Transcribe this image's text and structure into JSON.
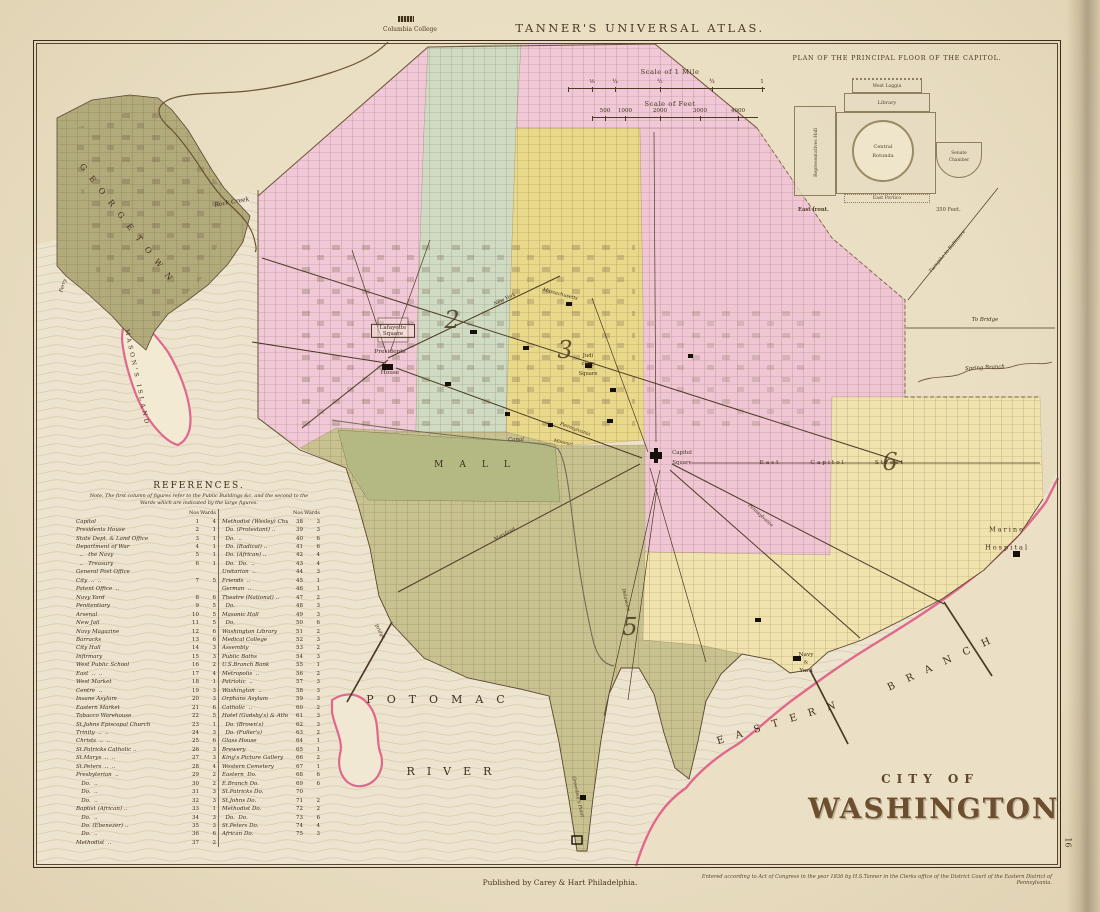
{
  "header": {
    "atlas_title": "TANNER'S UNIVERSAL ATLAS.",
    "columbia_college": "Columbia College"
  },
  "inset": {
    "title": "PLAN OF THE PRINCIPAL FLOOR OF THE CAPITOL.",
    "labels": {
      "west_loggia": "West Loggia",
      "library": "Library",
      "rep_hall": "Representatives Hall",
      "rotunda_1": "Central",
      "rotunda_2": "Rotunda",
      "senate_1": "Senate",
      "senate_2": "Chamber",
      "east_portico": "East Portico",
      "east_front": "East front.",
      "feet": "350 Feet."
    }
  },
  "scales": {
    "mile_title": "Scale of 1 Mile",
    "mile_ticks": [
      "⅛",
      "¼",
      "½",
      "¾",
      "1"
    ],
    "feet_title": "Scale of Feet",
    "feet_ticks": [
      "500",
      "1000",
      "2000",
      "3000",
      "4000"
    ]
  },
  "references": {
    "title": "REFERENCES.",
    "note_1": "Note. The first column of figures refer to the Public Buildings &c, and the second to the",
    "note_2": "Wards which are indicated by the large figures.",
    "col_no": "Nos",
    "col_wards": "Wards",
    "left": [
      {
        "n": "Capitol",
        "no": "1",
        "w": "4"
      },
      {
        "n": "Presidents House",
        "no": "2",
        "w": "1"
      },
      {
        "n": "State Dept. & Land Office",
        "no": "3",
        "w": "1"
      },
      {
        "n": "Department of War",
        "no": "4",
        "w": "1"
      },
      {
        "n": "  ..   the Navy",
        "no": "5",
        "w": "1"
      },
      {
        "n": "  ..   Treasury",
        "no": "6",
        "w": "1"
      },
      {
        "n": "General Post Office",
        "no": "",
        "w": ""
      },
      {
        "n": "City  ..  ..",
        "no": "7",
        "w": "5"
      },
      {
        "n": "Patent Office  ..",
        "no": "",
        "w": ""
      },
      {
        "n": "Navy Yard",
        "no": "8",
        "w": "6"
      },
      {
        "n": "Penitentiary",
        "no": "9",
        "w": "5"
      },
      {
        "n": "Arsenal",
        "no": "10",
        "w": "5"
      },
      {
        "n": "New Jail",
        "no": "11",
        "w": "5"
      },
      {
        "n": "Navy Magazine",
        "no": "12",
        "w": "6"
      },
      {
        "n": "Barracks",
        "no": "13",
        "w": "6"
      },
      {
        "n": "City Hall",
        "no": "14",
        "w": "3"
      },
      {
        "n": "Infirmary",
        "no": "15",
        "w": "3"
      },
      {
        "n": "West Public School",
        "no": "16",
        "w": "2"
      },
      {
        "n": "East  ..  ..",
        "no": "17",
        "w": "4"
      },
      {
        "n": "West Market",
        "no": "18",
        "w": "1"
      },
      {
        "n": "Centre  ..",
        "no": "19",
        "w": "3"
      },
      {
        "n": "Insane Asylum",
        "no": "20",
        "w": "3"
      },
      {
        "n": "Eastern Market",
        "no": "21",
        "w": "6"
      },
      {
        "n": "Tobacco Warehouse",
        "no": "22",
        "w": "5"
      },
      {
        "n": "St.Johns Episcopal Church",
        "no": "23",
        "w": "1"
      },
      {
        "n": "Trinity  ..  ..",
        "no": "24",
        "w": "3"
      },
      {
        "n": "Christs  ..  ..",
        "no": "25",
        "w": "6"
      },
      {
        "n": "St.Patricks Catholic ..",
        "no": "26",
        "w": "3"
      },
      {
        "n": "St.Marys  ..  ..",
        "no": "27",
        "w": "3"
      },
      {
        "n": "St.Peters  ..  ..",
        "no": "28",
        "w": "4"
      },
      {
        "n": "Presbyterian  ..",
        "no": "29",
        "w": "2"
      },
      {
        "n": "   Do.  ..",
        "no": "30",
        "w": "2"
      },
      {
        "n": "   Do.  ..",
        "no": "31",
        "w": "3"
      },
      {
        "n": "   Do.  ..",
        "no": "32",
        "w": "3"
      },
      {
        "n": "Baptist (African) ..",
        "no": "33",
        "w": "1"
      },
      {
        "n": "   Do.  ..",
        "no": "34",
        "w": "3"
      },
      {
        "n": "   Do. (Ebenezer) ..",
        "no": "35",
        "w": "3"
      },
      {
        "n": "   Do.  ..",
        "no": "36",
        "w": "6"
      },
      {
        "n": "Methodist  ..",
        "no": "37",
        "w": "2"
      }
    ],
    "right": [
      {
        "n": "Methodist (Wesley) Church",
        "no": "38",
        "w": "3"
      },
      {
        "n": "  Do. (Protestant) ..",
        "no": "39",
        "w": "3"
      },
      {
        "n": "  Do.  ..",
        "no": "40",
        "w": "6"
      },
      {
        "n": "  Do. (Radical) ..",
        "no": "41",
        "w": "6"
      },
      {
        "n": "  Do. (African) ..",
        "no": "42",
        "w": "4"
      },
      {
        "n": "  Do.  Do.  ..",
        "no": "43",
        "w": "4"
      },
      {
        "n": "Unitarian  ..",
        "no": "44",
        "w": "3"
      },
      {
        "n": "Friends  ..",
        "no": "45",
        "w": "1"
      },
      {
        "n": "German  ..",
        "no": "46",
        "w": "1"
      },
      {
        "n": "Theatre (National) ..",
        "no": "47",
        "w": "2"
      },
      {
        "n": "  Do.",
        "no": "48",
        "w": "3"
      },
      {
        "n": "Masonic Hall",
        "no": "49",
        "w": "3"
      },
      {
        "n": "  Do.",
        "no": "50",
        "w": "6"
      },
      {
        "n": "Washington Library",
        "no": "51",
        "w": "2"
      },
      {
        "n": "Medical College",
        "no": "52",
        "w": "3"
      },
      {
        "n": "Assembly",
        "no": "53",
        "w": "2"
      },
      {
        "n": "Public Baths",
        "no": "54",
        "w": "3"
      },
      {
        "n": "U.S.Branch Bank",
        "no": "55",
        "w": "1"
      },
      {
        "n": "Metropolis  ..",
        "no": "56",
        "w": "2"
      },
      {
        "n": "Patriotic  ..",
        "no": "57",
        "w": "3"
      },
      {
        "n": "Washington  ..",
        "no": "58",
        "w": "3"
      },
      {
        "n": "Orphans Asylum",
        "no": "59",
        "w": "3"
      },
      {
        "n": "Catholic  ..",
        "no": "60",
        "w": "2"
      },
      {
        "n": "Hotel (Gadsby's) & Athen.m",
        "no": "61",
        "w": "3"
      },
      {
        "n": "  Do. (Brown's)",
        "no": "62",
        "w": "3"
      },
      {
        "n": "  Do. (Fuller's)",
        "no": "63",
        "w": "2"
      },
      {
        "n": "Glass House",
        "no": "64",
        "w": "1"
      },
      {
        "n": "Brewery",
        "no": "65",
        "w": "1"
      },
      {
        "n": "King's Picture Gallery",
        "no": "66",
        "w": "2"
      },
      {
        "n": "Western Cemetery",
        "no": "67",
        "w": "1"
      },
      {
        "n": "Eastern  Do.",
        "no": "68",
        "w": "6"
      },
      {
        "n": "E.Branch Do.",
        "no": "69",
        "w": "6"
      },
      {
        "n": "St.Patricks Do.",
        "no": "70",
        "w": ""
      },
      {
        "n": "St.Johns Do.",
        "no": "71",
        "w": "2"
      },
      {
        "n": "Methodist Do.",
        "no": "72",
        "w": "2"
      },
      {
        "n": "  Do.  Do.",
        "no": "73",
        "w": "6"
      },
      {
        "n": "St.Peters Do.",
        "no": "74",
        "w": "4"
      },
      {
        "n": "African Do.",
        "no": "75",
        "w": "3"
      }
    ]
  },
  "map_title": {
    "line1": "CITY OF",
    "line2": "WASHINGTON."
  },
  "footer": {
    "publisher": "Published by Carey & Hart Philadelphia.",
    "copyright": "Entered according to Act of Congress in the year 1836 by H.S.Tanner in the Clerks office of the District Court of the Eastern District of Pennsylvania.",
    "page_number": "16"
  },
  "map_labels": [
    {
      "id": "georgetown",
      "t": "GEORGETOWN",
      "x": 128,
      "y": 226,
      "s": 8,
      "r": 52,
      "ls": 9
    },
    {
      "id": "rock-creek",
      "t": "Rock Creek",
      "x": 232,
      "y": 203,
      "s": 6,
      "r": -10,
      "i": 1
    },
    {
      "id": "ferry",
      "t": "Ferry",
      "x": 64,
      "y": 286,
      "s": 5,
      "r": -72,
      "i": 1
    },
    {
      "id": "masons-island",
      "t": "MASON'S ISLAND",
      "x": 136,
      "y": 378,
      "s": 6,
      "r": 78,
      "ls": 3
    },
    {
      "id": "lafayette-square",
      "t": "Lafayette Square",
      "x": 393,
      "y": 331,
      "s": 5.6,
      "r": 0,
      "c": "boxed"
    },
    {
      "id": "presidents-house-1",
      "t": "Presidents",
      "x": 390,
      "y": 352,
      "s": 5.8
    },
    {
      "id": "presidents-house-2",
      "t": "House",
      "x": 390,
      "y": 373,
      "s": 5.8
    },
    {
      "id": "judiciary-1",
      "t": "Judi",
      "x": 588,
      "y": 357,
      "s": 5.2
    },
    {
      "id": "judiciary-2",
      "t": "ciary",
      "x": 588,
      "y": 365,
      "s": 5.2
    },
    {
      "id": "judiciary-3",
      "t": "Square",
      "x": 588,
      "y": 375,
      "s": 5.2
    },
    {
      "id": "capitol-square-1",
      "t": "Capitol",
      "x": 682,
      "y": 454,
      "s": 5.4
    },
    {
      "id": "capitol-square-2",
      "t": "Square",
      "x": 682,
      "y": 464,
      "s": 5.4
    },
    {
      "id": "east-capitol-1",
      "t": "East",
      "x": 770,
      "y": 463,
      "s": 5.8,
      "ls": 2
    },
    {
      "id": "east-capitol-2",
      "t": "Capitol",
      "x": 828,
      "y": 463,
      "s": 5.8,
      "ls": 2
    },
    {
      "id": "east-capitol-3",
      "t": "Street",
      "x": 890,
      "y": 463,
      "s": 5.8,
      "ls": 2
    },
    {
      "id": "mall",
      "t": "MALL",
      "x": 480,
      "y": 466,
      "s": 9,
      "ls": 16
    },
    {
      "id": "canal",
      "t": "Canal",
      "x": 516,
      "y": 441,
      "s": 5.4,
      "i": 1
    },
    {
      "id": "navy-yard-1",
      "t": "Navy",
      "x": 806,
      "y": 655,
      "s": 5.8
    },
    {
      "id": "navy-yard-amp",
      "t": "&",
      "x": 806,
      "y": 663,
      "s": 5
    },
    {
      "id": "navy-yard-2",
      "t": "Yard",
      "x": 806,
      "y": 671,
      "s": 5.8
    },
    {
      "id": "marine-hospital-1",
      "t": "Marine",
      "x": 1007,
      "y": 530,
      "s": 6.6,
      "ls": 2
    },
    {
      "id": "marine-hospital-2",
      "t": "Hospital",
      "x": 1007,
      "y": 548,
      "s": 6.6,
      "ls": 2
    },
    {
      "id": "potomac",
      "t": "POTOMAC",
      "x": 442,
      "y": 700,
      "s": 11,
      "ls": 13
    },
    {
      "id": "river",
      "t": "RIVER",
      "x": 455,
      "y": 772,
      "s": 11,
      "ls": 12
    },
    {
      "id": "eastern",
      "t": "EASTERN",
      "x": 782,
      "y": 722,
      "s": 10,
      "r": -17,
      "ls": 12
    },
    {
      "id": "branch",
      "t": "BRANCH",
      "x": 945,
      "y": 662,
      "s": 10,
      "r": -25,
      "ls": 13
    },
    {
      "id": "spring-branch",
      "t": "Spring Branch",
      "x": 985,
      "y": 369,
      "s": 5.4,
      "i": 1,
      "r": -3
    },
    {
      "id": "to-bridge",
      "t": "To Bridge",
      "x": 985,
      "y": 321,
      "s": 5.4,
      "i": 1
    },
    {
      "id": "turnpike",
      "t": "Turnpike to Baltimore",
      "x": 948,
      "y": 252,
      "s": 4.8,
      "i": 1,
      "r": -50
    },
    {
      "id": "greenleafs-point",
      "t": "Greenleaf's Point",
      "x": 577,
      "y": 797,
      "s": 4.8,
      "i": 1,
      "r": 78
    },
    {
      "id": "bridge",
      "t": "Bridge",
      "x": 379,
      "y": 632,
      "s": 4.8,
      "i": 1,
      "r": 60
    },
    {
      "id": "ward-2",
      "t": "2",
      "x": 452,
      "y": 320,
      "s": 24,
      "c": "ward"
    },
    {
      "id": "ward-3",
      "t": "3",
      "x": 565,
      "y": 350,
      "s": 24,
      "c": "ward"
    },
    {
      "id": "ward-5",
      "t": "5",
      "x": 630,
      "y": 627,
      "s": 24,
      "c": "ward"
    },
    {
      "id": "ward-6",
      "t": "6",
      "x": 890,
      "y": 462,
      "s": 24,
      "c": "ward"
    },
    {
      "id": "pennsylvania-1",
      "t": "Pennsylvania",
      "x": 575,
      "y": 430,
      "s": 4.8,
      "i": 1,
      "r": 20
    },
    {
      "id": "pennsylvania-2",
      "t": "Pennsylvania",
      "x": 760,
      "y": 516,
      "s": 4.8,
      "i": 1,
      "r": 42
    },
    {
      "id": "maryland",
      "t": "Maryland",
      "x": 505,
      "y": 535,
      "s": 4.8,
      "i": 1,
      "r": -28
    },
    {
      "id": "massachusetts",
      "t": "Massachusetts",
      "x": 560,
      "y": 295,
      "s": 4.8,
      "i": 1,
      "r": 15
    },
    {
      "id": "new-york",
      "t": "New York",
      "x": 505,
      "y": 300,
      "s": 4.8,
      "i": 1,
      "r": -25
    },
    {
      "id": "missouri",
      "t": "Missouri",
      "x": 563,
      "y": 444,
      "s": 4.4,
      "i": 1,
      "r": 12
    },
    {
      "id": "delaware",
      "t": "Delaware",
      "x": 625,
      "y": 600,
      "s": 4.8,
      "i": 1,
      "r": 77
    }
  ],
  "colors": {
    "paper": "#e9ddc2",
    "water": "#ece4cf",
    "georgetown": "#b1aa7b",
    "ward_pink": "#f1c8d7",
    "ward_green": "#cfdcc3",
    "ward_yellow": "#e9d98a",
    "ward_olive": "#c8c291",
    "ward_pale_yellow": "#f1e3ae",
    "mall": "#b4b983",
    "shore_pink": "#e0688c",
    "ink": "#4c3a24"
  }
}
